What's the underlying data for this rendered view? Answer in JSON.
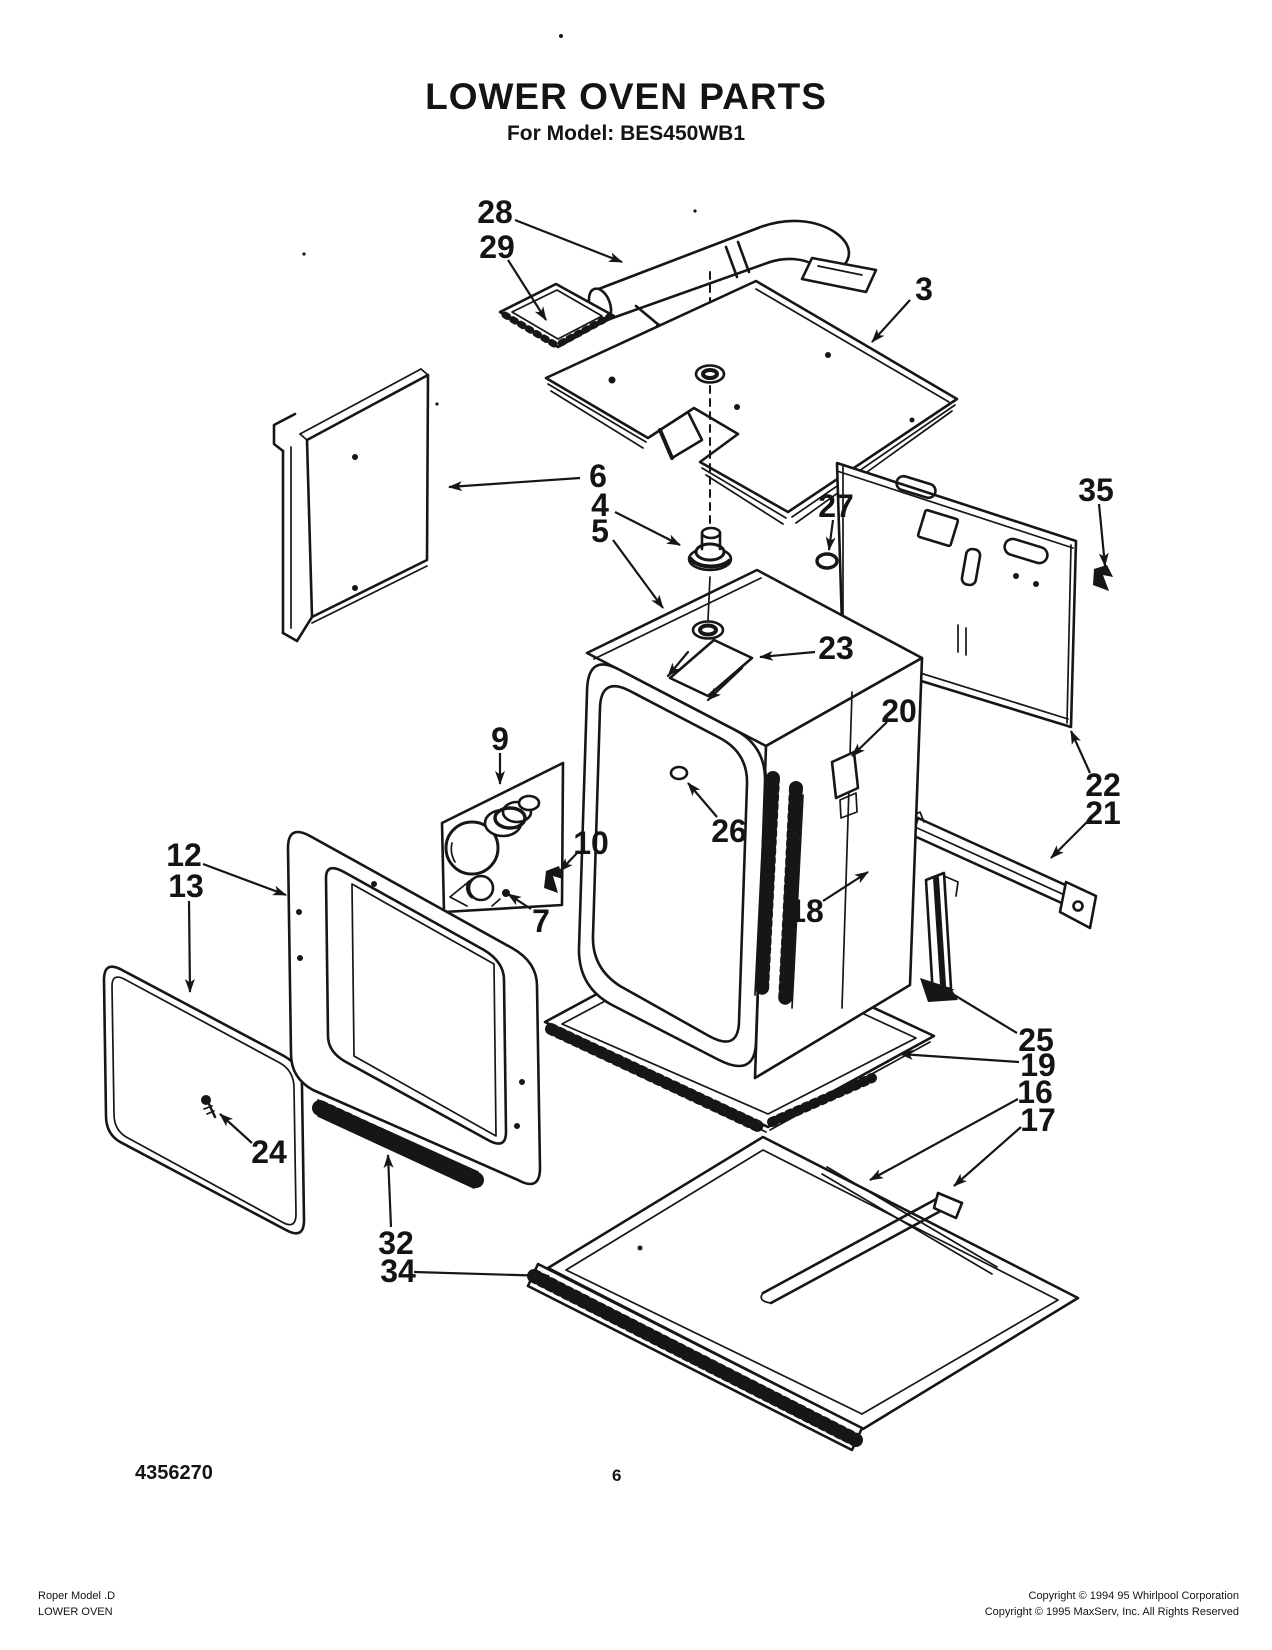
{
  "document": {
    "title": "LOWER OVEN PARTS",
    "subtitle": "For Model: BES450WB1",
    "doc_number": "4356270",
    "page_number": "6",
    "footer_left_line1": "Roper Model .D",
    "footer_left_line2": "LOWER OVEN",
    "footer_right_line1": "Copyright © 1994 95 Whirlpool Corporation",
    "footer_right_line2": "Copyright © 1995 MaxServ, Inc.  All Rights Reserved"
  },
  "diagram": {
    "ink_color": "#161616",
    "parts": [
      {
        "label": "28",
        "x": 495,
        "y": 212,
        "leader": [
          515,
          220,
          622,
          262
        ]
      },
      {
        "label": "29",
        "x": 497,
        "y": 247,
        "leader": [
          508,
          260,
          546,
          320
        ]
      },
      {
        "label": "3",
        "x": 924,
        "y": 289,
        "leader": [
          910,
          300,
          872,
          342
        ]
      },
      {
        "label": "6",
        "x": 598,
        "y": 476,
        "leader": [
          580,
          478,
          449,
          487
        ]
      },
      {
        "label": "4",
        "x": 600,
        "y": 505,
        "leader": [
          615,
          512,
          680,
          545
        ]
      },
      {
        "label": "5",
        "x": 600,
        "y": 531,
        "leader": [
          613,
          540,
          663,
          608
        ]
      },
      {
        "label": "27",
        "x": 836,
        "y": 506,
        "leader": [
          833,
          520,
          829,
          550
        ]
      },
      {
        "label": "35",
        "x": 1096,
        "y": 490,
        "leader": [
          1099,
          504,
          1105,
          566
        ]
      },
      {
        "label": "23",
        "x": 836,
        "y": 648,
        "leader": [
          815,
          652,
          760,
          657
        ]
      },
      {
        "label": "20",
        "x": 899,
        "y": 711,
        "leader": [
          887,
          722,
          852,
          756
        ]
      },
      {
        "label": "26",
        "x": 729,
        "y": 831,
        "leader": [
          717,
          817,
          688,
          783
        ]
      },
      {
        "label": "9",
        "x": 500,
        "y": 739,
        "leader": [
          500,
          753,
          500,
          784
        ]
      },
      {
        "label": "10",
        "x": 591,
        "y": 843,
        "leader": [
          578,
          852,
          560,
          871
        ]
      },
      {
        "label": "7",
        "x": 541,
        "y": 921,
        "leader": [
          531,
          909,
          508,
          894
        ]
      },
      {
        "label": "22",
        "x": 1103,
        "y": 785,
        "leader": [
          1090,
          773,
          1071,
          731
        ]
      },
      {
        "label": "21",
        "x": 1103,
        "y": 813,
        "leader": [
          1087,
          822,
          1051,
          858
        ]
      },
      {
        "label": "18",
        "x": 806,
        "y": 911,
        "leader": [
          823,
          901,
          868,
          872
        ]
      },
      {
        "label": "25",
        "x": 1036,
        "y": 1040,
        "leader": [
          1017,
          1033,
          941,
          987
        ]
      },
      {
        "label": "19",
        "x": 1038,
        "y": 1065,
        "leader": [
          1019,
          1062,
          900,
          1054
        ]
      },
      {
        "label": "16",
        "x": 1035,
        "y": 1092,
        "leader": [
          1018,
          1099,
          870,
          1180
        ]
      },
      {
        "label": "17",
        "x": 1038,
        "y": 1120,
        "leader": [
          1021,
          1127,
          954,
          1186
        ]
      },
      {
        "label": "12",
        "x": 184,
        "y": 855,
        "leader": [
          203,
          864,
          286,
          895
        ]
      },
      {
        "label": "13",
        "x": 186,
        "y": 886,
        "leader": [
          189,
          901,
          190,
          992
        ]
      },
      {
        "label": "24",
        "x": 269,
        "y": 1152,
        "leader": [
          252,
          1143,
          220,
          1114
        ]
      },
      {
        "label": "32",
        "x": 396,
        "y": 1243,
        "leader": [
          391,
          1227,
          388,
          1155
        ]
      },
      {
        "label": "34",
        "x": 398,
        "y": 1271,
        "leader": [
          414,
          1272,
          549,
          1276
        ]
      }
    ]
  }
}
